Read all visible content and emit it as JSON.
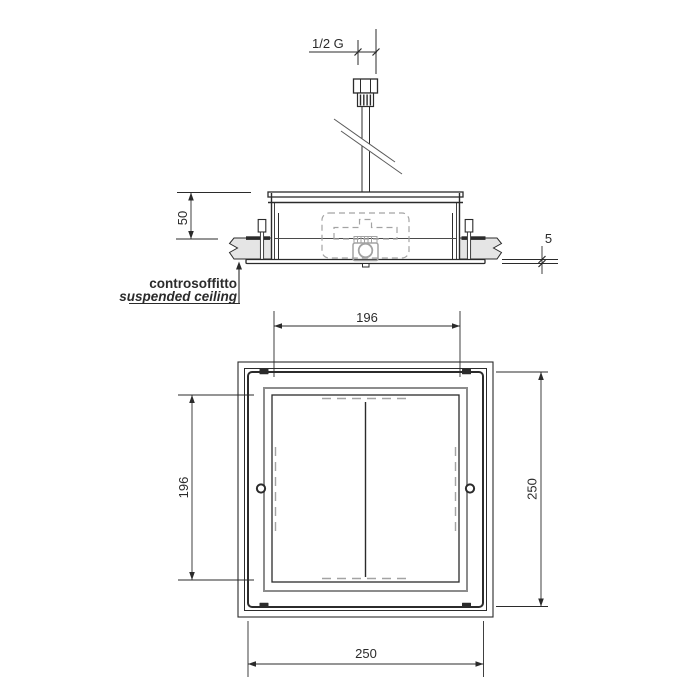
{
  "side_view": {
    "connection_label": "1/2 G",
    "depth_dim": "50",
    "flange_thickness_dim": "5",
    "ceiling_label_it": "controsoffitto",
    "ceiling_label_en": "suspended ceiling"
  },
  "plan_view": {
    "top_dim": "196",
    "left_dim": "196",
    "right_dim": "250",
    "bottom_dim": "250"
  },
  "colors": {
    "line": "#2b2b2b",
    "panel_line": "#8c8c8c",
    "hidden_line": "#a3a3a3",
    "ceiling_fill": "#e5e5e5",
    "background": "#ffffff"
  }
}
